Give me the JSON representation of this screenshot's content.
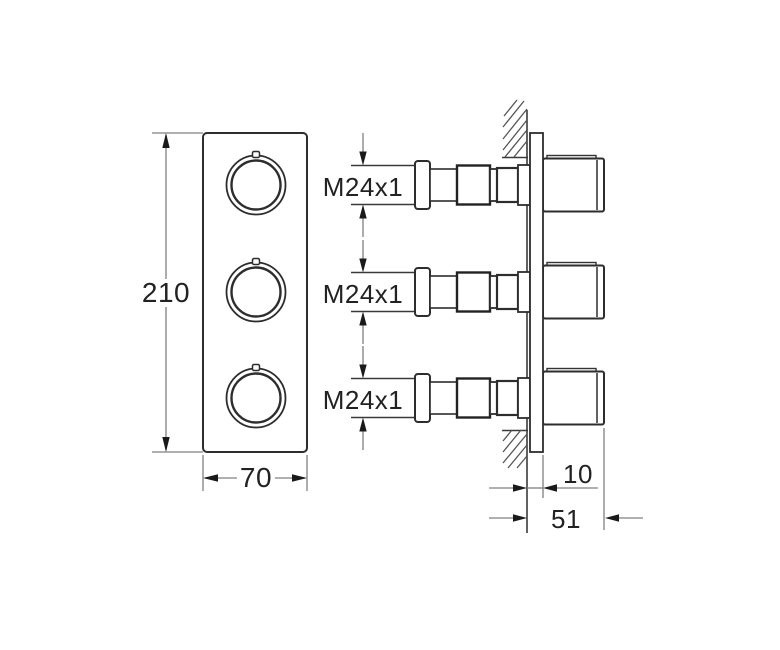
{
  "drawing": {
    "type": "technical-dimension-drawing",
    "front_view": {
      "height_label": "210",
      "width_label": "70",
      "handle_count": 3
    },
    "side_view": {
      "thread_labels": [
        "M24x1",
        "M24x1",
        "M24x1"
      ],
      "plate_offset_label": "10",
      "depth_label": "51"
    },
    "colors": {
      "background": "#ffffff",
      "outline": "#2d2d2d",
      "dim_line": "#808080",
      "arrow": "#1a1a1a",
      "text": "#222222"
    }
  }
}
